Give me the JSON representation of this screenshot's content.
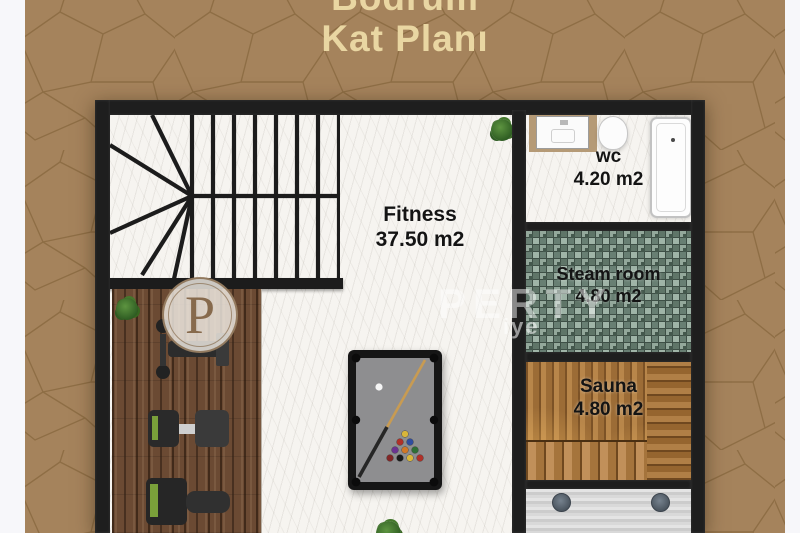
{
  "title": {
    "line1": "Bodrum",
    "line2": "Kat Planı"
  },
  "rooms": {
    "fitness": {
      "name": "Fitness",
      "area": "37.50 m2"
    },
    "wc": {
      "name": "wc",
      "area": "4.20 m2"
    },
    "steam_room": {
      "name": "Steam room",
      "area": "4.80 m2"
    },
    "sauna": {
      "name": "Sauna",
      "area": "4.80 m2"
    }
  },
  "watermark": {
    "logo_letter": "P",
    "overlay_text": "PERTY",
    "small_text": "iye"
  },
  "colors": {
    "photo_background": "#a5835c",
    "title_text": "#e9d6a2",
    "wall": "#1e1e1e",
    "steam_tile": "#7c9286",
    "sauna_wood": "#b8864a",
    "gym_floor": "#6b4a33",
    "label_text": "#141414"
  }
}
